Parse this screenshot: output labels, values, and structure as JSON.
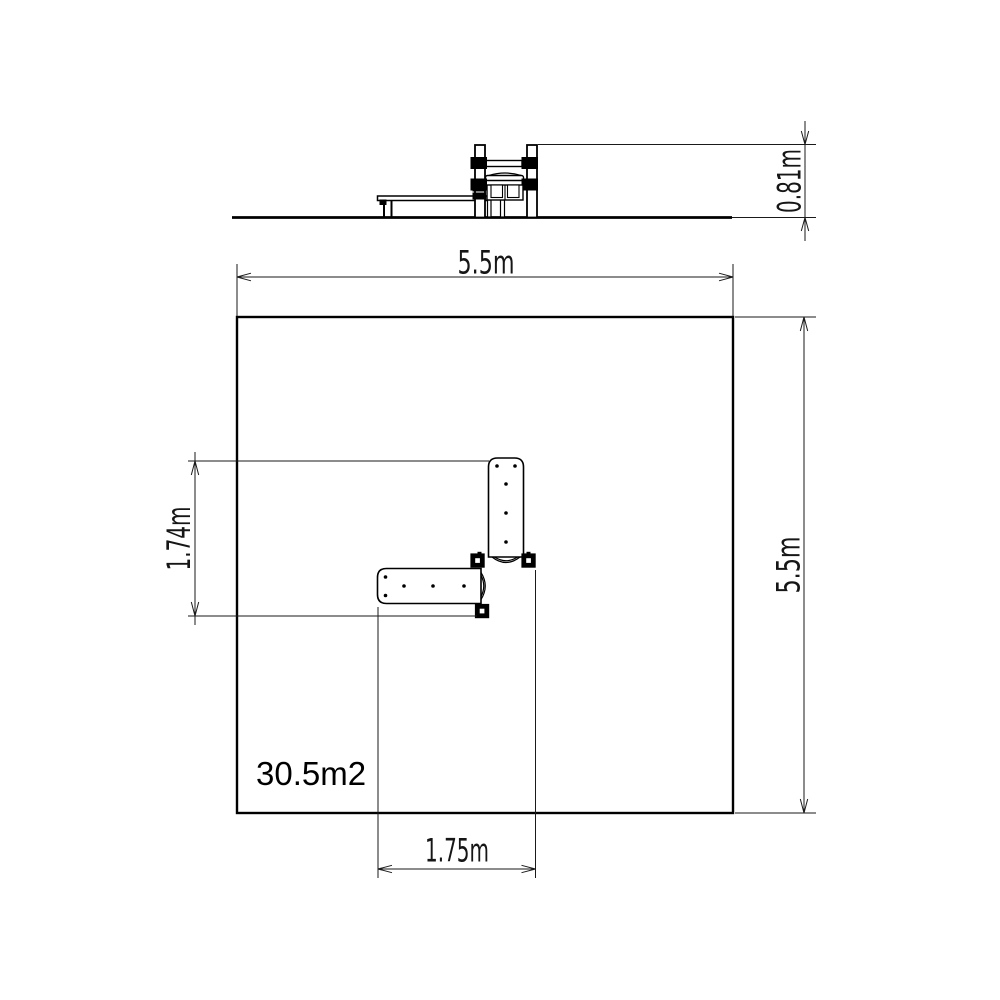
{
  "drawing": {
    "colors": {
      "ink": "#000000",
      "paper": "#ffffff"
    },
    "elevation": {
      "height_dim": "0.81m"
    },
    "plan": {
      "width_dim": "5.5m",
      "depth_dim": "5.5m",
      "equipment_width_dim": "1.75m",
      "equipment_depth_dim": "1.74m",
      "area_label": "30.5m2"
    }
  }
}
